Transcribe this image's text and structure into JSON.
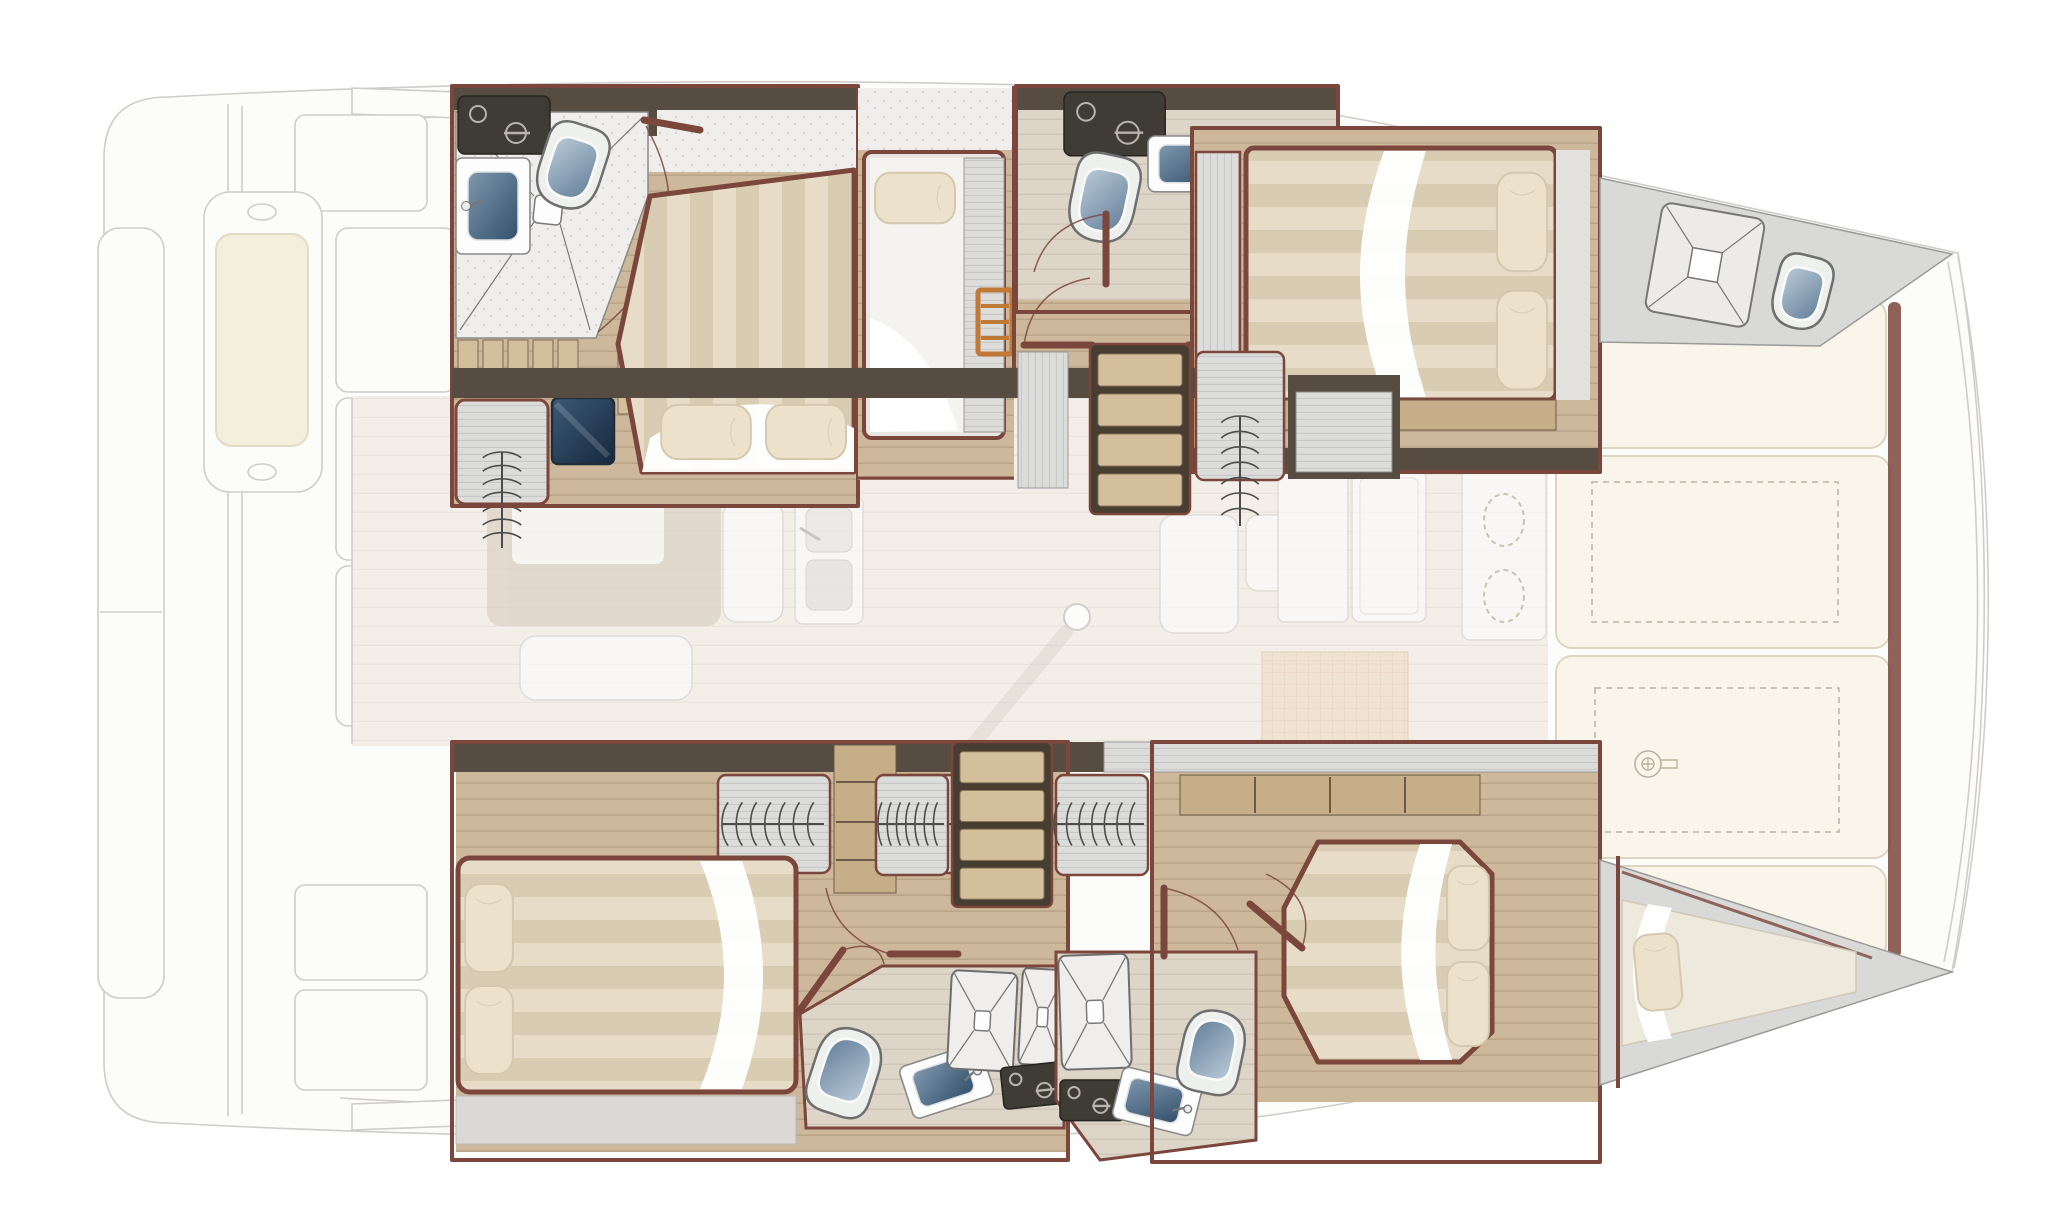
{
  "page": {
    "title": "Catamaran yacht interior layout – top-view floor plan",
    "kind": "boat-floor-plan",
    "orientation": "bow-right"
  },
  "palette": {
    "bg": "#ffffff",
    "faded_stroke": "#cfcdc9",
    "faded_fill": "#fcfcfb",
    "furn_white": "#fbfbfa",
    "furn_stroke": "#d9d6d1",
    "cushion": "#f4eedd",
    "cushion_line": "#e4dac2",
    "table_taupe": "#dbd1c3",
    "saloon_floor": "#f3efe8",
    "saloon_line": "#e8e2d8",
    "wood_floor": "#cdb89c",
    "wood_line": "#b7a284",
    "wood_light": "#d4bf9d",
    "wood_shelf": "#c6ae88",
    "wall_dark": "#564c41",
    "wall_maroon": "#7b463b",
    "tile_light": "#efeeec",
    "tile_dot": "#d6d3cf",
    "bath_floor": "#ddd5c8",
    "bath_line": "#cbc2b2",
    "locker_gray": "#dcdcdb",
    "locker_line": "#9a9895",
    "hanger": "#4c4c4c",
    "bed_a": "#e6dcc8",
    "bed_b": "#d8ccb2",
    "sheet": "#ffffff",
    "pillow": "#ece2cc",
    "pillow_line": "#d4c8ae",
    "berth_gray": "#e7e6e2",
    "lid_a": "#b9cad8",
    "lid_b": "#647f99",
    "basin_a": "#7e97ad",
    "basin_b": "#33506b",
    "tv_a": "#3d5a78",
    "tv_b": "#16283c",
    "panel_dark": "#3f3b35",
    "panel_icon": "#b9b5ae",
    "deck_gray": "#d9d9d7",
    "deck_line": "#9a9a98",
    "sunpad": "#f9f5ea",
    "sunpad_line": "#ddd5c2",
    "dash": "#bdb49f",
    "ladder": "#c07a36",
    "grid_a": "#eeddc6",
    "grid_b": "#dcc3a2",
    "shadow": "#b9b5ad"
  },
  "regions": {
    "aft_cockpit": "aft cockpit (faded upper deck)",
    "saloon": "saloon and galley (faded main deck)",
    "port_hull": "port hull cabins",
    "starboard_hull": "starboard hull cabins",
    "port_aft_cabin": "port aft double cabin",
    "port_aft_head": "port aft bathroom",
    "port_single_berth": "port single berth",
    "port_fwd_head": "port forward bathroom",
    "port_fwd_cabin": "port forward double cabin",
    "port_bow_deck": "port bow deck with hatch and toilet",
    "stbd_aft_cabin": "starboard aft double cabin",
    "stbd_aft_head": "starboard aft bathroom",
    "stbd_fwd_cabin": "starboard forward double cabin",
    "stbd_fwd_head": "starboard forward bathroom",
    "stbd_bow_berth": "starboard bow berth",
    "fore_cockpit": "forward cockpit sunpads",
    "companionway_port": "port companionway stairs",
    "companionway_stbd": "starboard companionway stairs"
  },
  "icons": [
    "toilet-icon",
    "shower-tray-icon",
    "sink-icon",
    "hanging-locker-icon",
    "pillow-icon",
    "electrical-panel-icon",
    "stair-steps-icon",
    "ladder-icon",
    "burner-icon",
    "windlass-icon",
    "door-swing-icon",
    "mast-icon",
    "deck-hatch-icon",
    "tv-icon"
  ]
}
